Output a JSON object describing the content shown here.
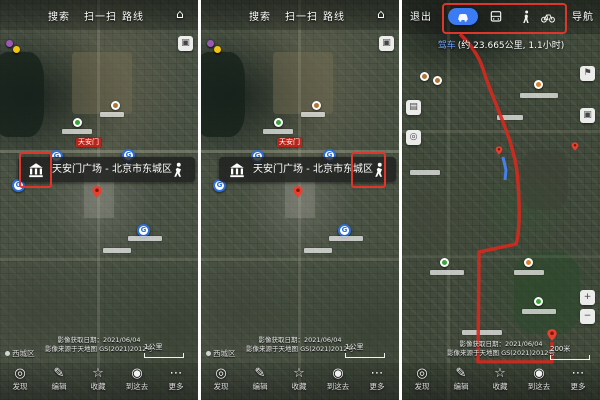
{
  "colors": {
    "annotation_red": "#e0352b",
    "accent_blue": "#3b7cf5",
    "route_red": "#d7281e"
  },
  "icons": {
    "home": "⌂",
    "layers": "▣",
    "traffic": "▤",
    "flag": "⚑",
    "zoom_in": "+",
    "zoom_out": "−",
    "metro_glyph": "G"
  },
  "top_bar": {
    "search": "搜索",
    "scan": "扫一扫",
    "route": "路线"
  },
  "poi_bar": {
    "title": "天安门广场 - 北京市东城区"
  },
  "map": {
    "tiananmen_label": "天安门",
    "district_label": "西城区",
    "scale_left": "1公里",
    "scale_right": "200米",
    "attribution_line1": "影像获取日期：2021/06/04",
    "attribution_line2": "影像来源于天地图 GS(2021)2012号"
  },
  "bottom_nav": {
    "items": [
      {
        "label": "发现",
        "glyph": "◎"
      },
      {
        "label": "编辑",
        "glyph": "✎"
      },
      {
        "label": "收藏",
        "glyph": "☆"
      },
      {
        "label": "到这去",
        "glyph": "◉"
      },
      {
        "label": "更多",
        "glyph": "⋯"
      }
    ]
  },
  "route_screen": {
    "exit": "退出",
    "navigate": "导航",
    "mode": "驾车",
    "info": "(约 23.665公里, 1.1小时)"
  }
}
